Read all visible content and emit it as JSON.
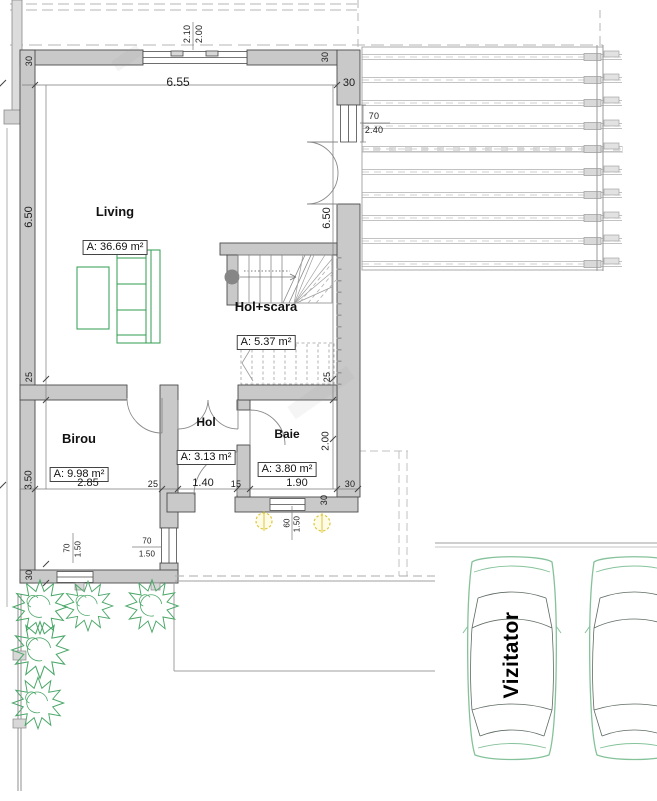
{
  "rooms": [
    {
      "id": "living",
      "name": "Living",
      "area": "A: 36.69 m²"
    },
    {
      "id": "hol_scara",
      "name": "Hol+scara",
      "area": "A: 5.37 m²"
    },
    {
      "id": "birou",
      "name": "Birou",
      "area": "A: 9.98 m²"
    },
    {
      "id": "hol",
      "name": "Hol",
      "area": "A: 3.13 m²"
    },
    {
      "id": "baie",
      "name": "Baie",
      "area": "A: 3.80 m²"
    }
  ],
  "parking": {
    "visitor_label": "Vizitator"
  },
  "dimensions": {
    "window_top_height_1": "2.10",
    "window_top_height_2": "2.00",
    "living_width": "6.55",
    "wall_thickness_top_left": "30",
    "wall_thickness_top_right": "30",
    "wall_thickness_right": "30",
    "window_right_width": "70",
    "window_right_height": "2.40",
    "living_height_left": "6.50",
    "living_height_right": "6.50",
    "wall_thickness_mid_left": "25",
    "stair_strip": "25",
    "birou_height": "3.50",
    "baie_height": "2.00",
    "wall_thickness_bottom_left": "30",
    "birou_width": "2.85",
    "wall_birou_hol": "25",
    "hol_width": "1.40",
    "wall_hol_baie": "15",
    "baie_width": "1.90",
    "wall_bottom_right": "30",
    "wall_bottom_right_end": "30",
    "window_birou_width": "70",
    "window_birou_height": "1.50",
    "window_porch_width": "70",
    "window_porch_height": "1.50",
    "window_baie_width": "60",
    "window_baie_height": "1.50"
  },
  "colors": {
    "wall_fill": "#c9c9c9",
    "wall_stroke": "#4a4a4a",
    "furniture_green": "#2f9e4f",
    "plant_green": "#4aa768",
    "car_green": "#85c29a",
    "lamp_yellow": "#ddc83c"
  }
}
